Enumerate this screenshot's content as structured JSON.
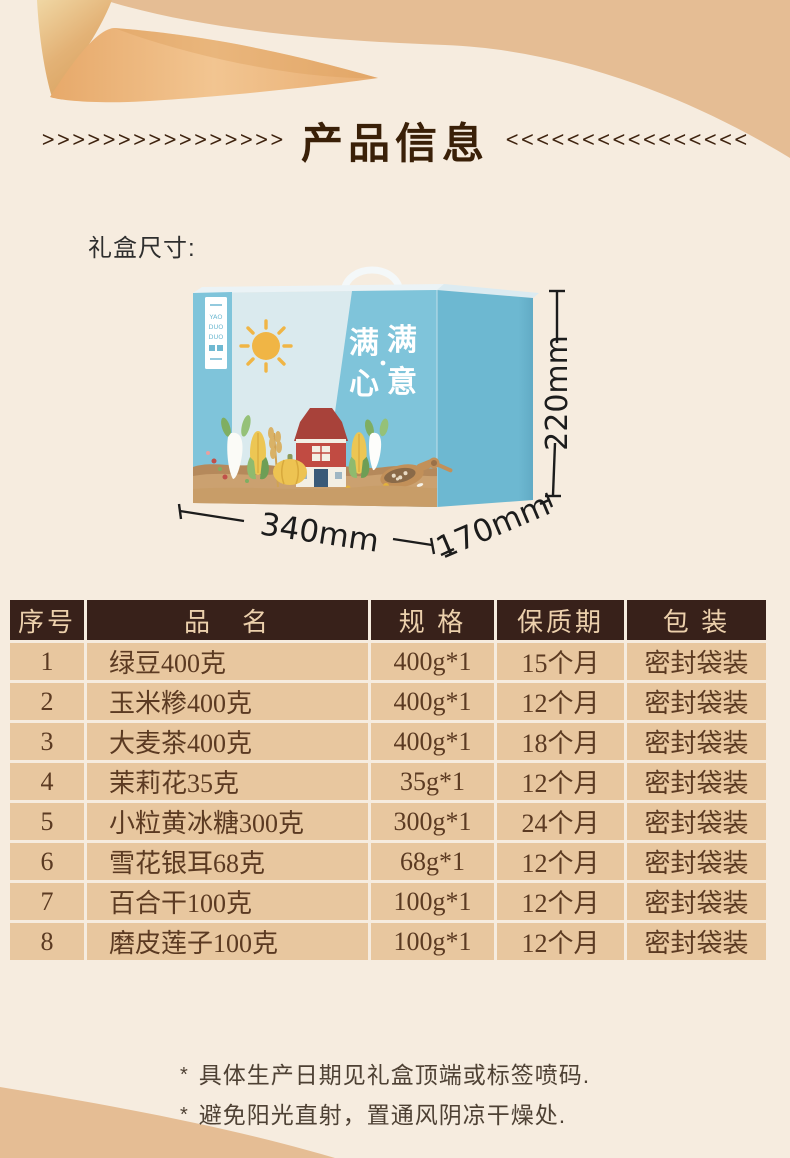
{
  "page": {
    "title": "产品信息",
    "chevrons_left": ">>>>>>>>>>>>>>>>",
    "chevrons_right": "<<<<<<<<<<<<<<<<"
  },
  "box_section": {
    "label": "礼盒尺寸:",
    "dimensions": {
      "width": "340mm",
      "depth": "170mm",
      "height": "220mm"
    },
    "box_art": {
      "brand_lines": [
        "YAO",
        "DUO",
        "DUO"
      ],
      "slogan": [
        "满",
        "满",
        "心",
        "意"
      ]
    }
  },
  "table": {
    "headers": [
      "序号",
      "品　名",
      "规 格",
      "保质期",
      "包 装"
    ],
    "rows": [
      {
        "no": "1",
        "name": "绿豆400克",
        "spec": "400g*1",
        "shelf_life": "15个月",
        "packing": "密封袋装"
      },
      {
        "no": "2",
        "name": "玉米糁400克",
        "spec": "400g*1",
        "shelf_life": "12个月",
        "packing": "密封袋装"
      },
      {
        "no": "3",
        "name": "大麦茶400克",
        "spec": "400g*1",
        "shelf_life": "18个月",
        "packing": "密封袋装"
      },
      {
        "no": "4",
        "name": "茉莉花35克",
        "spec": "35g*1",
        "shelf_life": "12个月",
        "packing": "密封袋装"
      },
      {
        "no": "5",
        "name": "小粒黄冰糖300克",
        "spec": "300g*1",
        "shelf_life": "24个月",
        "packing": "密封袋装"
      },
      {
        "no": "6",
        "name": "雪花银耳68克",
        "spec": "68g*1",
        "shelf_life": "12个月",
        "packing": "密封袋装"
      },
      {
        "no": "7",
        "name": "百合干100克",
        "spec": "100g*1",
        "shelf_life": "12个月",
        "packing": "密封袋装"
      },
      {
        "no": "8",
        "name": "磨皮莲子100克",
        "spec": "100g*1",
        "shelf_life": "12个月",
        "packing": "密封袋装"
      }
    ]
  },
  "notes": {
    "marker": "*",
    "lines": [
      "具体生产日期见礼盒顶端或标签喷码.",
      "避免阳光直射，置通风阴凉干燥处."
    ]
  },
  "colors": {
    "background_tan": "#e5bd94",
    "panel_cream": "#f6ecdf",
    "table_header_bg": "#38211a",
    "table_header_text": "#ecd0ac",
    "table_row_bg": "#e8c79f",
    "table_row_text": "#5b3a22",
    "title_brown": "#3a2008",
    "box_blue": "#7fc4da",
    "box_side_blue": "#6db8d1",
    "ribbon_gold": "#e3b276"
  }
}
